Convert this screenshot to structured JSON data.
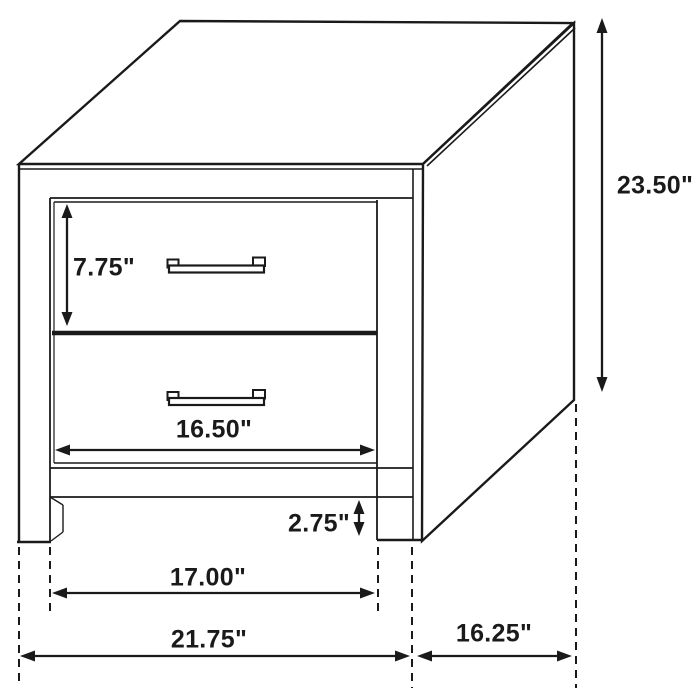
{
  "figure": {
    "background": "#ffffff",
    "line_color": "#1a1a1a",
    "labels": {
      "height": "23.50\"",
      "drawer_height": "7.75\"",
      "drawer_width": "16.50\"",
      "clearance": "2.75\"",
      "leg_span": "17.00\"",
      "overall_width": "21.75\"",
      "depth": "16.25\""
    }
  }
}
